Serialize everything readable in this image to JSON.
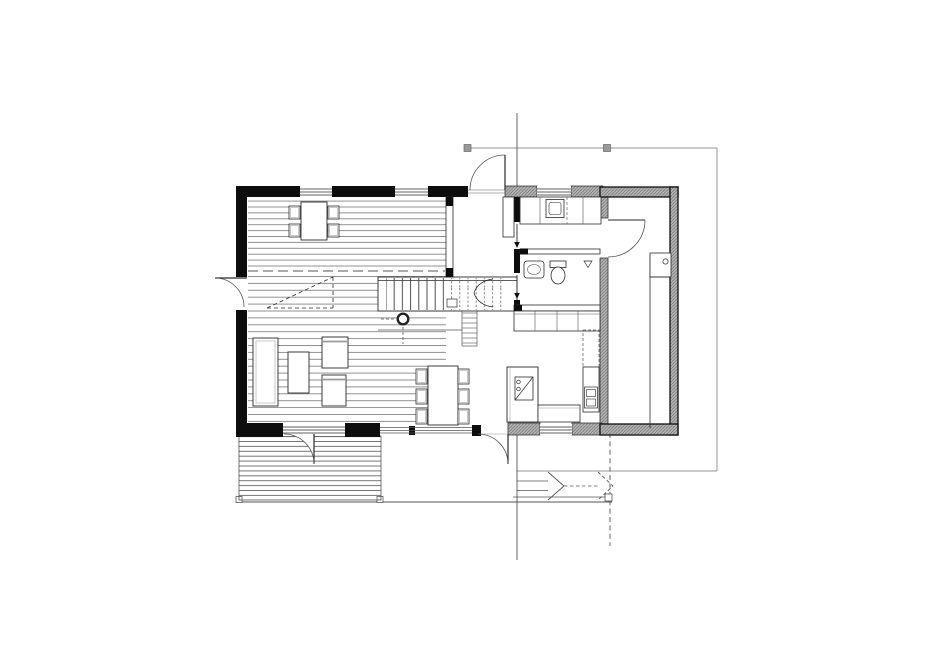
{
  "plan": {
    "title_semantic": "ground-floor-architectural-plan",
    "canvas": {
      "width": 940,
      "height": 664
    },
    "colors": {
      "background": "#ffffff",
      "wall_solid": "#0d0d0d",
      "wall_hatch_fill": "#b3b3b3",
      "wall_hatch_line": "#707070",
      "line_dark": "#2a2a2a",
      "line_medium": "#555555",
      "line_light": "#949494",
      "floor_line": "#757575"
    },
    "rooms": [
      {
        "name": "front-room",
        "floor": "wood-boards",
        "furniture": [
          "table-with-4-chairs"
        ]
      },
      {
        "name": "living-room",
        "floor": "wood-boards",
        "furniture": [
          "sofa",
          "coffee-table",
          "armchair",
          "armchair"
        ]
      },
      {
        "name": "entry-hall",
        "floor": "plain",
        "furniture": [
          "hall-closet",
          "stair",
          "column"
        ]
      },
      {
        "name": "utility-room",
        "floor": "plain",
        "furniture": [
          "counter",
          "washing-machine"
        ]
      },
      {
        "name": "bathroom",
        "floor": "plain",
        "furniture": [
          "wash-basin",
          "toilet",
          "floor-drain"
        ]
      },
      {
        "name": "kitchen-dining-area",
        "floor": "plain",
        "furniture": [
          "dining-table-with-6-chairs",
          "kitchen-island-with-sink",
          "counter",
          "oven-unit",
          "wardrobe-row"
        ]
      },
      {
        "name": "storage-room",
        "floor": "plain",
        "furniture": [
          "workbench"
        ]
      },
      {
        "name": "wood-deck",
        "floor": "deck-boards",
        "furniture": []
      },
      {
        "name": "terrace",
        "floor": "plain",
        "furniture": [
          "exterior-steps"
        ]
      }
    ],
    "openings": {
      "windows": 6,
      "exterior_doors": 5,
      "interior_doors": 3,
      "sliding_doors": 2
    },
    "annotations": [
      "section-cut-line",
      "canopy-outline-with-posts",
      "terrace-edge-with-posts",
      "void-dashed-triangle",
      "stair-break-chevrons"
    ]
  }
}
